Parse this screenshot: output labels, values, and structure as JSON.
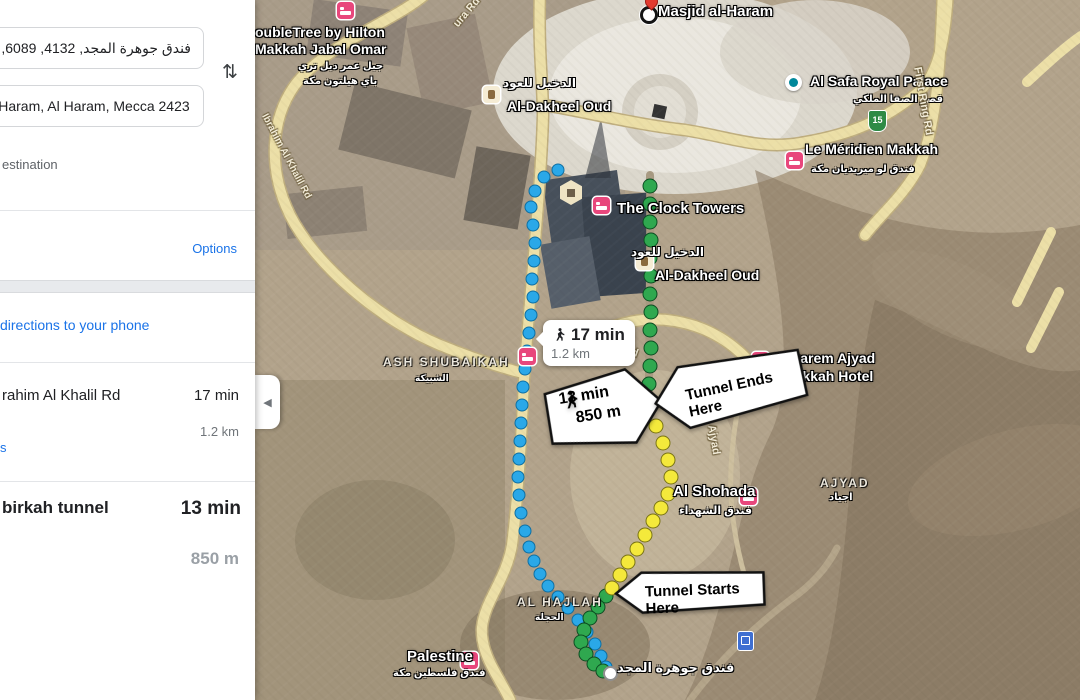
{
  "sidebar": {
    "origin_value": "فندق جوهرة المجد, 4132, 6089, الهجلة, م",
    "destination_value": "d al-Haram, Al Haram, Mecca 2423",
    "swap_glyph": "⇅",
    "add_destination": "estination",
    "options": "Options",
    "send_to_phone": "directions to your phone",
    "details_fragment": "s",
    "routes": [
      {
        "name": "rahim Al Khalil Rd",
        "duration": "17 min",
        "distance": "1.2 km",
        "selected": false
      },
      {
        "name": "birkah tunnel",
        "duration": "13 min",
        "distance": "850 m",
        "selected": true
      }
    ]
  },
  "map": {
    "collapse_glyph": "◀",
    "badges": {
      "walk_badge": {
        "duration": "17 min",
        "distance": "1.2 km"
      },
      "walk_callout": {
        "duration": "13 min",
        "distance": "850 m"
      },
      "tunnel_ends": "Tunnel Ends Here",
      "tunnel_starts": "Tunnel Starts Here",
      "route_shield": "15"
    },
    "colors": {
      "route_blue": "#2aa8e8",
      "route_green": "#2fa84f",
      "route_yellow": "#f4e93b",
      "road_yellow": "#ecdfa7",
      "poi_pink": "#e8477c",
      "link_blue": "#1a73e8"
    },
    "labels": [
      {
        "name": "masjid-al-haram-label",
        "text": "Masjid al-Haram",
        "x": 403,
        "y": 3,
        "kind": "place",
        "size": 15
      },
      {
        "name": "doubletree-label-line1",
        "text": "oubleTree by Hilton",
        "x": 0,
        "y": 24,
        "kind": "place",
        "size": 14
      },
      {
        "name": "doubletree-label-line2",
        "text": "Makkah Jabal Omar",
        "x": 0,
        "y": 41,
        "kind": "place",
        "size": 14
      },
      {
        "name": "doubletree-arabic-line1",
        "text": "جبل عمر دبل تري",
        "x": 43,
        "y": 61,
        "kind": "arabic",
        "size": 10
      },
      {
        "name": "doubletree-arabic-line2",
        "text": "باي هيلتون مكة",
        "x": 48,
        "y": 76,
        "kind": "arabic",
        "size": 10
      },
      {
        "name": "al-dakheel-top-arabic",
        "text": "الدخيل للعود",
        "x": 248,
        "y": 76,
        "kind": "arabic",
        "size": 12
      },
      {
        "name": "al-dakheel-top-label",
        "text": "Al-Dakheel Oud",
        "x": 252,
        "y": 98,
        "kind": "place",
        "size": 14
      },
      {
        "name": "al-safa-label",
        "text": "Al Safa Royal Palace",
        "x": 555,
        "y": 73,
        "kind": "place",
        "size": 14
      },
      {
        "name": "al-safa-arabic",
        "text": "قصر الصفا الملكي",
        "x": 598,
        "y": 94,
        "kind": "arabic",
        "size": 10
      },
      {
        "name": "le-meridien-label",
        "text": "Le Méridien Makkah",
        "x": 550,
        "y": 141,
        "kind": "place",
        "size": 14
      },
      {
        "name": "le-meridien-arabic",
        "text": "فندق لو ميريديان مكة",
        "x": 556,
        "y": 164,
        "kind": "arabic",
        "size": 10
      },
      {
        "name": "first-ring-rd-right-label",
        "text": "First Ring Rd",
        "x": 668,
        "y": 66,
        "kind": "road",
        "size": 11,
        "rot": 80
      },
      {
        "name": "ura-rd-label",
        "text": "ura Rd",
        "x": 196,
        "y": 22,
        "kind": "road",
        "size": 11,
        "rot": -50
      },
      {
        "name": "ibrahim-al-khalil-rd-label",
        "text": "Ibrahim Al Khalil Rd",
        "x": 14,
        "y": 112,
        "kind": "road",
        "size": 10,
        "rot": 62
      },
      {
        "name": "clock-towers-label",
        "text": "The Clock Towers",
        "x": 362,
        "y": 200,
        "kind": "place",
        "size": 15
      },
      {
        "name": "al-dakheel-2-arabic",
        "text": "الدخيل للعود",
        "x": 376,
        "y": 245,
        "kind": "arabic",
        "size": 12
      },
      {
        "name": "al-dakheel-2-label",
        "text": "Al-Dakheel Oud",
        "x": 400,
        "y": 267,
        "kind": "place",
        "size": 14
      },
      {
        "name": "first-ring-rd-center-label",
        "text": "First Ring Rd",
        "x": 320,
        "y": 325,
        "kind": "road",
        "size": 11,
        "rot": 20
      },
      {
        "name": "makarem-label-line1",
        "text": "Makarem Ajyad",
        "x": 518,
        "y": 350,
        "kind": "place",
        "size": 14
      },
      {
        "name": "makarem-label-line2",
        "text": "Makkah Hotel",
        "x": 528,
        "y": 368,
        "kind": "place",
        "size": 14
      },
      {
        "name": "ajyad-rd-label",
        "text": "Ajyad",
        "x": 462,
        "y": 424,
        "kind": "road",
        "size": 11,
        "rot": 80
      },
      {
        "name": "al-shohada-label",
        "text": "Al Shohada",
        "x": 418,
        "y": 483,
        "kind": "place",
        "size": 15
      },
      {
        "name": "al-shohada-arabic",
        "text": "فندق الشهداء",
        "x": 424,
        "y": 504,
        "kind": "arabic",
        "size": 11
      },
      {
        "name": "ajyad-district-label",
        "text": "AJYAD",
        "x": 565,
        "y": 476,
        "kind": "district",
        "size": 12
      },
      {
        "name": "ajyad-district-arabic",
        "text": "اجياد",
        "x": 574,
        "y": 492,
        "kind": "arabic",
        "size": 10
      },
      {
        "name": "ash-shubaikah-label",
        "text": "ASH SHUBAIKAH",
        "x": 128,
        "y": 355,
        "kind": "district",
        "size": 12
      },
      {
        "name": "ash-shubaikah-arabic",
        "text": "الشبيكة",
        "x": 160,
        "y": 373,
        "kind": "arabic",
        "size": 9
      },
      {
        "name": "al-hajlah-label",
        "text": "AL HAJLAH",
        "x": 262,
        "y": 595,
        "kind": "district",
        "size": 12
      },
      {
        "name": "al-hajlah-arabic",
        "text": "الحجلة",
        "x": 280,
        "y": 612,
        "kind": "arabic",
        "size": 9
      },
      {
        "name": "palestine-label",
        "text": "Palestine",
        "x": 152,
        "y": 648,
        "kind": "place",
        "size": 15
      },
      {
        "name": "palestine-arabic",
        "text": "فندق فلسطين مكة",
        "x": 138,
        "y": 668,
        "kind": "arabic",
        "size": 10
      },
      {
        "name": "jawharat-al-majd-arabic",
        "text": "فندق جوهرة المجد",
        "x": 362,
        "y": 660,
        "kind": "arabic",
        "size": 13
      }
    ],
    "icons": [
      {
        "name": "masjid-destination-marker",
        "kind": "dest",
        "x": 385,
        "y": 6
      },
      {
        "name": "masjid-red-pin-icon",
        "kind": "pin",
        "x": 390,
        "y": -5
      },
      {
        "name": "doubletree-hotel-icon",
        "kind": "hotel",
        "x": 82,
        "y": 2
      },
      {
        "name": "al-dakheel-top-shop-icon",
        "kind": "shop",
        "x": 228,
        "y": 86
      },
      {
        "name": "al-safa-place-icon",
        "kind": "teal",
        "x": 530,
        "y": 74
      },
      {
        "name": "le-meridien-hotel-icon",
        "kind": "hotel",
        "x": 531,
        "y": 152
      },
      {
        "name": "route-15-shield-icon",
        "kind": "shield",
        "text": "15",
        "x": 613,
        "y": 110
      },
      {
        "name": "clock-towers-hotel-icon",
        "kind": "hotel",
        "x": 338,
        "y": 197
      },
      {
        "name": "kaaba-landmark-icon",
        "kind": "hex",
        "x": 305,
        "y": 180
      },
      {
        "name": "al-dakheel-2-shop-icon",
        "kind": "shop",
        "x": 381,
        "y": 253
      },
      {
        "name": "roadside-hotel-icon",
        "kind": "hotel",
        "x": 264,
        "y": 348
      },
      {
        "name": "makarem-hotel-icon",
        "kind": "hotel",
        "x": 497,
        "y": 352
      },
      {
        "name": "al-shohada-hotel-icon",
        "kind": "hotel",
        "x": 485,
        "y": 488
      },
      {
        "name": "palestine-hotel-icon",
        "kind": "hotel",
        "x": 206,
        "y": 652
      },
      {
        "name": "transit-badge-icon",
        "kind": "transit",
        "x": 482,
        "y": 631
      },
      {
        "name": "origin-marker",
        "kind": "startdot",
        "x": 348,
        "y": 666
      }
    ],
    "route_dots": [
      {
        "name": "blue-route-dot",
        "color": "blue",
        "points": [
          [
            303,
            170
          ],
          [
            289,
            177
          ],
          [
            280,
            191
          ],
          [
            276,
            207
          ],
          [
            278,
            225
          ],
          [
            280,
            243
          ],
          [
            279,
            261
          ],
          [
            277,
            279
          ],
          [
            278,
            297
          ],
          [
            276,
            315
          ],
          [
            274,
            333
          ],
          [
            272,
            351
          ],
          [
            270,
            369
          ],
          [
            268,
            387
          ],
          [
            267,
            405
          ],
          [
            266,
            423
          ],
          [
            265,
            441
          ],
          [
            264,
            459
          ],
          [
            263,
            477
          ],
          [
            264,
            495
          ],
          [
            266,
            513
          ],
          [
            270,
            531
          ],
          [
            274,
            547
          ],
          [
            279,
            561
          ],
          [
            285,
            574
          ],
          [
            293,
            586
          ],
          [
            303,
            597
          ],
          [
            313,
            608
          ],
          [
            323,
            620
          ],
          [
            332,
            632
          ],
          [
            340,
            644
          ],
          [
            346,
            656
          ],
          [
            351,
            667
          ]
        ]
      },
      {
        "name": "green-route-dot",
        "color": "green",
        "points": [
          [
            395,
            186
          ],
          [
            395,
            204
          ],
          [
            395,
            222
          ],
          [
            396,
            240
          ],
          [
            395,
            258
          ],
          [
            396,
            276
          ],
          [
            395,
            294
          ],
          [
            396,
            312
          ],
          [
            395,
            330
          ],
          [
            396,
            348
          ],
          [
            395,
            366
          ],
          [
            394,
            384
          ],
          [
            393,
            400
          ],
          [
            351,
            596
          ],
          [
            343,
            607
          ],
          [
            335,
            618
          ],
          [
            329,
            630
          ],
          [
            326,
            642
          ],
          [
            331,
            654
          ],
          [
            339,
            664
          ],
          [
            348,
            671
          ]
        ]
      },
      {
        "name": "yellow-route-dot",
        "color": "yellow",
        "points": [
          [
            401,
            426
          ],
          [
            408,
            443
          ],
          [
            413,
            460
          ],
          [
            416,
            477
          ],
          [
            413,
            494
          ],
          [
            406,
            508
          ],
          [
            398,
            521
          ],
          [
            390,
            535
          ],
          [
            382,
            549
          ],
          [
            373,
            562
          ],
          [
            365,
            575
          ],
          [
            357,
            588
          ]
        ]
      }
    ]
  }
}
